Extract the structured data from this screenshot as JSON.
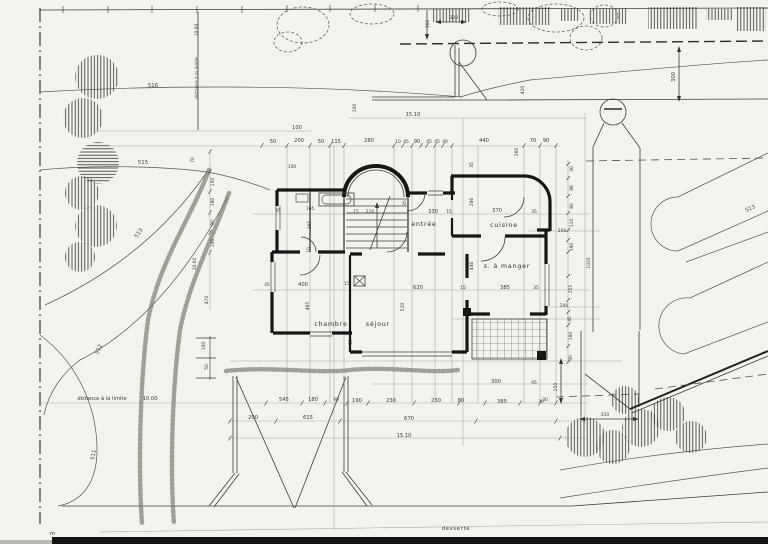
{
  "drawing": {
    "kind": "architectural site and ground-floor plan (scanned blueprint)",
    "colors": {
      "paper": "#f3f2ee",
      "ink": "#161614",
      "light_ink": "#8f8f88",
      "scan_bar": "#141414"
    }
  },
  "rooms": {
    "entree": "entrée",
    "cuisine": "cuisine",
    "salle_a_manger": "s. à manger",
    "chambre": "chambre",
    "sejour": "séjour"
  },
  "site": {
    "desserte": "desserte",
    "scale_unit": "m",
    "distance_label_bottom": "distance à la limite",
    "distance_value_bottom": "10.00",
    "distance_label_left": "distance à la limite",
    "distance_value_left": "10.00"
  },
  "contours": {
    "c516": "516",
    "c515": "515",
    "c513_left": "513",
    "c512": "512",
    "c511": "511",
    "c513_right": "513"
  },
  "dims": {
    "top": [
      "100",
      "50",
      "200",
      "50",
      "115",
      "280",
      "10",
      "45",
      "90",
      "45",
      "45",
      "40",
      "440",
      "70",
      "90"
    ],
    "top_misc": [
      "100",
      "15.10",
      "360",
      "320",
      "420",
      "260",
      "300",
      "35",
      "100"
    ],
    "left_chain": [
      "70",
      "100",
      "180",
      "90",
      "100",
      "470",
      "10.00",
      "100",
      "50"
    ],
    "interior": [
      "95",
      "165",
      "15",
      "210",
      "265",
      "330",
      "15",
      "370",
      "35",
      "286",
      "448",
      "620",
      "15",
      "385",
      "35",
      "45",
      "400",
      "15",
      "485",
      "520",
      "10",
      "35",
      "35"
    ],
    "right_chain": [
      "30",
      "98",
      "80",
      "110",
      "200",
      "190",
      "255",
      "200",
      "45",
      "180",
      "30",
      "250",
      "30",
      "1020",
      "310"
    ],
    "bottom": [
      "300",
      "95",
      "545",
      "180",
      "90",
      "190",
      "230",
      "230",
      "80",
      "385",
      "30",
      "200",
      "615",
      "670",
      "15.10"
    ]
  }
}
